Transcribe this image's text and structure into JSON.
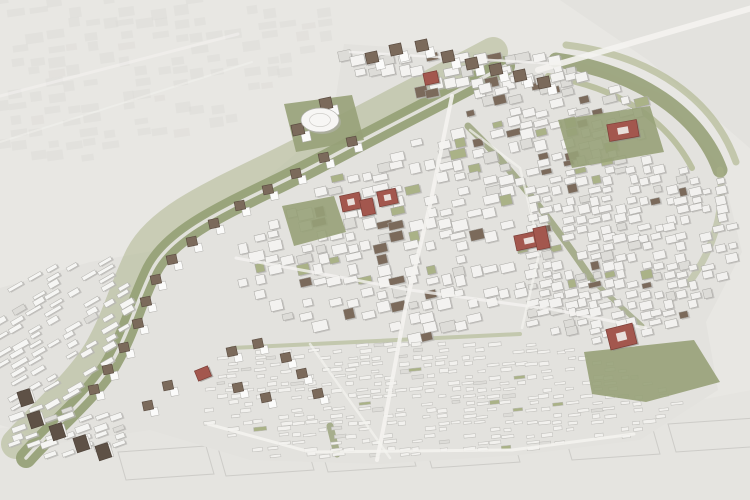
{
  "scene": {
    "name": "urban-masterplan-aerial-rendering",
    "canvas": {
      "width": 750,
      "height": 500
    },
    "palette": {
      "background": "#e8e7e3",
      "context_fill": "#deddd9",
      "site_ground": "#e3e2de",
      "green_primary": "#97a178",
      "green_light": "#aab287",
      "building_white": "#f4f3f1",
      "building_gray": "#dddcd8",
      "building_shadow": "#b8b7b3",
      "roof_brown": "#7b6a5b",
      "roof_dark": "#5e5146",
      "accent_red": "#a3574e",
      "accent_red_dark": "#7c3e37",
      "road_white": "#f4f3f0",
      "outline": "#c7c6c2"
    },
    "context": {
      "top_right_poly": [
        [
          560,
          0
        ],
        [
          752,
          0
        ],
        [
          752,
          150
        ],
        [
          648,
          60
        ]
      ],
      "bottom_poly": [
        [
          0,
          428
        ],
        [
          206,
          424
        ],
        [
          260,
          458
        ],
        [
          520,
          455
        ],
        [
          640,
          436
        ],
        [
          700,
          400
        ],
        [
          752,
          390
        ],
        [
          752,
          500
        ],
        [
          0,
          500
        ]
      ],
      "plot_outlines": [
        [
          118,
          452
        ],
        [
          218,
          448
        ],
        [
          320,
          444
        ],
        [
          424,
          440
        ],
        [
          564,
          432
        ],
        [
          668,
          424
        ]
      ]
    },
    "site_boundary": [
      [
        344,
        44
      ],
      [
        570,
        58
      ],
      [
        665,
        95
      ],
      [
        722,
        170
      ],
      [
        742,
        252
      ],
      [
        706,
        322
      ],
      [
        718,
        390
      ],
      [
        640,
        440
      ],
      [
        520,
        455
      ],
      [
        380,
        464
      ],
      [
        250,
        460
      ],
      [
        150,
        430
      ],
      [
        60,
        443
      ],
      [
        0,
        425
      ],
      [
        0,
        288
      ],
      [
        90,
        262
      ],
      [
        170,
        248
      ],
      [
        235,
        205
      ],
      [
        300,
        150
      ],
      [
        336,
        96
      ]
    ],
    "green_corridors": [
      {
        "d": "M 493,52 C 433,84 373,114 313,146 C 238,186 163,211 140,256 C 123,291 118,316 100,348 C 82,380 45,412 16,444",
        "width": 30,
        "color": "green_light",
        "opacity": 0.5
      },
      {
        "d": "M 505,66 C 445,98 385,128 325,160 C 250,200 175,225 152,270 C 135,305 130,330 112,362 C 94,394 55,425 26,458",
        "width": 20,
        "color": "green_primary",
        "opacity": 0.95
      },
      {
        "d": "M 505,66 C 445,98 385,128 325,160 C 250,200 175,225 152,270 C 135,305 130,330 112,362 C 94,394 55,425 26,458",
        "width": 3.5,
        "color": "#e9e8e4",
        "opacity": 0.9
      },
      {
        "d": "M 556,60 C 640,72 700,115 720,170",
        "width": 15,
        "color": "green_primary",
        "opacity": 0.9
      },
      {
        "d": "M 566,45 C 654,56 714,100 736,162",
        "width": 7,
        "color": "green_light",
        "opacity": 0.6
      },
      {
        "d": "M 548,76 C 622,88 668,122 692,168",
        "width": 6,
        "color": "green_light",
        "opacity": 0.7
      },
      {
        "d": "M 720,170 C 726,212 712,252 688,284",
        "width": 7,
        "color": "green_light",
        "opacity": 0.5
      },
      {
        "d": "M 468,126 C 505,162 545,210 592,280",
        "width": 7,
        "color": "green_primary",
        "opacity": 0.8
      },
      {
        "d": "M 592,280 L 642,326",
        "width": 5,
        "color": "green_primary",
        "opacity": 0.7
      },
      {
        "d": "M 232,348 L 520,334",
        "width": 4,
        "color": "green_light",
        "opacity": 0.55
      },
      {
        "d": "M 330,426 L 337,454",
        "width": 7,
        "color": "green_primary",
        "opacity": 0.8
      }
    ],
    "parks": [
      {
        "name": "dome-park",
        "pts": [
          [
            284,
            104
          ],
          [
            352,
            95
          ],
          [
            364,
            140
          ],
          [
            296,
            152
          ]
        ]
      },
      {
        "name": "central-park",
        "pts": [
          [
            282,
            206
          ],
          [
            334,
            196
          ],
          [
            346,
            232
          ],
          [
            294,
            246
          ]
        ]
      },
      {
        "name": "north-east-field",
        "pts": [
          [
            558,
            120
          ],
          [
            650,
            106
          ],
          [
            664,
            152
          ],
          [
            572,
            168
          ]
        ]
      },
      {
        "name": "south-east-park",
        "pts": [
          [
            584,
            352
          ],
          [
            694,
            340
          ],
          [
            720,
            382
          ],
          [
            646,
            402
          ],
          [
            592,
            394
          ]
        ]
      }
    ],
    "fabric_zones": [
      {
        "name": "context-top-left",
        "poly": [
          [
            0,
            0
          ],
          [
            320,
            0
          ],
          [
            345,
            40
          ],
          [
            240,
            118
          ],
          [
            110,
            160
          ],
          [
            0,
            168
          ]
        ],
        "angle": -8,
        "cell": [
          14,
          8
        ],
        "sp": [
          18,
          12
        ],
        "seed": 61,
        "skip": 0.45,
        "fill": "#dcdbd7",
        "stroke": "none",
        "opacity": 0.5,
        "shadow": false
      },
      {
        "name": "top-edge-blocks",
        "poly": [
          [
            344,
            46
          ],
          [
            564,
            58
          ],
          [
            584,
            82
          ],
          [
            470,
            96
          ],
          [
            380,
            92
          ],
          [
            344,
            68
          ]
        ],
        "angle": -12,
        "cell": [
          12,
          9
        ],
        "sp": [
          15,
          12
        ],
        "seed": 7,
        "skip": 0.3,
        "roofProb": 0.3,
        "fill": "#f4f3f1",
        "stroke": "#a9a8a4",
        "shadow": true
      },
      {
        "name": "north-east-blocks",
        "poly": [
          [
            458,
            90
          ],
          [
            556,
            68
          ],
          [
            648,
            100
          ],
          [
            660,
            148
          ],
          [
            560,
            168
          ],
          [
            470,
            128
          ]
        ],
        "angle": -14,
        "cell": [
          11,
          8
        ],
        "sp": [
          14,
          11
        ],
        "seed": 11,
        "skip": 0.3,
        "roofProb": 0.12,
        "courtyardProb": 0.08,
        "fill": "#f3f2f0",
        "stroke": "#a9a8a4",
        "shadow": true
      },
      {
        "name": "central-blocks",
        "poly": [
          [
            470,
            132
          ],
          [
            515,
            172
          ],
          [
            522,
            300
          ],
          [
            432,
            340
          ],
          [
            312,
            332
          ],
          [
            228,
            282
          ],
          [
            232,
            252
          ],
          [
            298,
            206
          ],
          [
            354,
            166
          ],
          [
            414,
            138
          ]
        ],
        "angle": -13,
        "cell": [
          12,
          8.5
        ],
        "sp": [
          15.5,
          11.5
        ],
        "seed": 23,
        "skip": 0.32,
        "roofProb": 0.05,
        "courtyardProb": 0.08,
        "fill": "#f3f2f0",
        "stroke": "#a9a8a4",
        "shadow": true
      },
      {
        "name": "east-blocks",
        "poly": [
          [
            520,
            165
          ],
          [
            655,
            152
          ],
          [
            724,
            182
          ],
          [
            740,
            252
          ],
          [
            704,
            320
          ],
          [
            598,
            344
          ],
          [
            520,
            328
          ]
        ],
        "angle": -13,
        "cell": [
          10,
          7
        ],
        "sp": [
          12.5,
          9.5
        ],
        "seed": 31,
        "skip": 0.3,
        "roofProb": 0.04,
        "courtyardProb": 0.07,
        "fill": "#f2f1ef",
        "stroke": "#a9a8a4",
        "shadow": true
      },
      {
        "name": "south-terrace-rows",
        "poly": [
          [
            226,
            352
          ],
          [
            420,
            338
          ],
          [
            580,
            348
          ],
          [
            688,
            398
          ],
          [
            636,
            436
          ],
          [
            512,
            452
          ],
          [
            378,
            460
          ],
          [
            252,
            456
          ],
          [
            208,
            424
          ],
          [
            210,
            382
          ]
        ],
        "angle": -6,
        "cell": [
          10,
          3.2
        ],
        "sp": [
          13,
          6.5
        ],
        "seed": 41,
        "skip": 0.42,
        "courtyardProb": 0.03,
        "fill": "#f2f1ee",
        "stroke": "#bdbcb8",
        "shadow": false
      },
      {
        "name": "west-estate",
        "poly": [
          [
            0,
            285
          ],
          [
            75,
            260
          ],
          [
            115,
            262
          ],
          [
            130,
            300
          ],
          [
            122,
            348
          ],
          [
            85,
            390
          ],
          [
            35,
            412
          ],
          [
            0,
            408
          ]
        ],
        "angle": -30,
        "cell": [
          14,
          4.5
        ],
        "sp": [
          18,
          8.5
        ],
        "seed": 53,
        "skip": 0.35,
        "fill": "#f6f6f4",
        "stroke": "#b3b2ae",
        "shadow": true
      },
      {
        "name": "south-west-estate",
        "poly": [
          [
            0,
            415
          ],
          [
            60,
            400
          ],
          [
            120,
            418
          ],
          [
            130,
            445
          ],
          [
            80,
            462
          ],
          [
            20,
            462
          ],
          [
            0,
            450
          ]
        ],
        "angle": -20,
        "cell": [
          13,
          5
        ],
        "sp": [
          17,
          9
        ],
        "seed": 59,
        "skip": 0.35,
        "fill": "#f5f5f3",
        "stroke": "#b3b2ae",
        "shadow": true
      }
    ],
    "roads": [
      {
        "pts": [
          [
            452,
            96
          ],
          [
            430,
            205
          ],
          [
            406,
            305
          ],
          [
            384,
            425
          ],
          [
            377,
            460
          ]
        ],
        "width": 4,
        "opacity": 0.9
      },
      {
        "pts": [
          [
            236,
            258
          ],
          [
            410,
            290
          ],
          [
            556,
            310
          ],
          [
            646,
            328
          ]
        ],
        "width": 3,
        "opacity": 0.8
      },
      {
        "pts": [
          [
            350,
            52
          ],
          [
            560,
            64
          ]
        ],
        "width": 2.5,
        "opacity": 0.8
      },
      {
        "pts": [
          [
            208,
            424
          ],
          [
            310,
            452
          ],
          [
            512,
            450
          ],
          [
            634,
            434
          ]
        ],
        "width": 3,
        "opacity": 0.85
      },
      {
        "pts": [
          [
            470,
            130
          ],
          [
            520,
            168
          ],
          [
            540,
            250
          ],
          [
            522,
            328
          ]
        ],
        "width": 2.5,
        "opacity": 0.7
      },
      {
        "pts": [
          [
            310,
            344
          ],
          [
            390,
            458
          ]
        ],
        "width": 2.5,
        "opacity": 0.7
      },
      {
        "pts": [
          [
            538,
            70
          ],
          [
            752,
            8
          ]
        ],
        "width": 6,
        "opacity": 0.9
      },
      {
        "pts": [
          [
            0,
            96
          ],
          [
            238,
            34
          ]
        ],
        "width": 3,
        "opacity": 0.55
      },
      {
        "pts": [
          [
            0,
            142
          ],
          [
            252,
            62
          ]
        ],
        "width": 2,
        "opacity": 0.45
      }
    ],
    "villas": [
      [
        352,
        142
      ],
      [
        324,
        158
      ],
      [
        296,
        174
      ],
      [
        268,
        190
      ],
      [
        240,
        206
      ],
      [
        214,
        224
      ],
      [
        192,
        242
      ],
      [
        172,
        260
      ],
      [
        156,
        280
      ],
      [
        146,
        302
      ],
      [
        138,
        324
      ],
      [
        124,
        348
      ],
      [
        108,
        370
      ],
      [
        94,
        390
      ],
      [
        232,
        352
      ],
      [
        258,
        344
      ],
      [
        286,
        358
      ],
      [
        238,
        388
      ],
      [
        266,
        398
      ],
      [
        302,
        374
      ],
      [
        318,
        394
      ],
      [
        168,
        386
      ],
      [
        148,
        406
      ]
    ],
    "towers": [
      [
        372,
        58
      ],
      [
        396,
        50
      ],
      [
        422,
        46
      ],
      [
        448,
        57
      ],
      [
        472,
        64
      ],
      [
        496,
        70
      ],
      [
        520,
        76
      ],
      [
        544,
        83
      ],
      [
        326,
        104
      ],
      [
        298,
        130
      ]
    ],
    "dark_towers": [
      [
        36,
        420
      ],
      [
        58,
        432
      ],
      [
        82,
        444
      ],
      [
        104,
        452
      ],
      [
        26,
        398
      ]
    ],
    "red_buildings": [
      {
        "x": 424,
        "y": 72,
        "w": 14,
        "h": 12,
        "rot": -12
      },
      {
        "x": 608,
        "y": 122,
        "w": 30,
        "h": 17,
        "rot": -10,
        "inner": true
      },
      {
        "x": 341,
        "y": 194,
        "w": 20,
        "h": 16,
        "rot": -12,
        "inner": true
      },
      {
        "x": 361,
        "y": 199,
        "w": 13,
        "h": 16,
        "rot": -12
      },
      {
        "x": 378,
        "y": 190,
        "w": 19,
        "h": 15,
        "rot": -12,
        "inner": true
      },
      {
        "x": 515,
        "y": 233,
        "w": 28,
        "h": 15,
        "rot": -12,
        "inner": true
      },
      {
        "x": 535,
        "y": 227,
        "w": 13,
        "h": 22,
        "rot": -12
      },
      {
        "x": 196,
        "y": 368,
        "w": 14,
        "h": 11,
        "rot": -22
      },
      {
        "x": 608,
        "y": 326,
        "w": 27,
        "h": 21,
        "rot": -14,
        "inner": true
      }
    ],
    "dome": {
      "cx": 320,
      "cy": 120,
      "rx": 19,
      "ry": 12
    }
  }
}
